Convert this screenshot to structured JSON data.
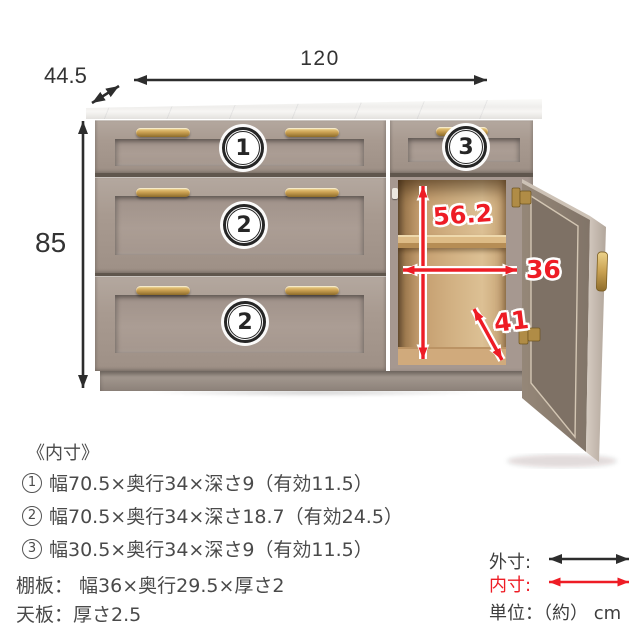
{
  "diagram": {
    "outer": {
      "width": "120",
      "depth": "44.5",
      "height": "85"
    },
    "inner": {
      "height": "56.2",
      "width": "36",
      "diagonal": "41"
    },
    "badges": [
      {
        "id": "drawer-1",
        "num": "1"
      },
      {
        "id": "drawer-2-middle",
        "num": "2"
      },
      {
        "id": "drawer-2-bottom",
        "num": "2"
      },
      {
        "id": "drawer-3",
        "num": "3"
      }
    ]
  },
  "specs": {
    "heading": "《内寸》",
    "items": [
      {
        "num": "1",
        "text": "幅70.5×奥行34×深さ9（有効11.5）"
      },
      {
        "num": "2",
        "text": "幅70.5×奥行34×深さ18.7（有効24.5）"
      },
      {
        "num": "3",
        "text": "幅30.5×奥行34×深さ9（有効11.5）"
      }
    ],
    "shelf": "棚板： 幅36×奥行29.5×厚さ2",
    "top": "天板：厚さ2.5"
  },
  "legend": {
    "outer_label": "外寸:",
    "inner_label": "内寸:",
    "unit_label": "単位：（約） cm"
  },
  "colors": {
    "accent_red": "#ee1c25",
    "arrow_black": "#2d2d2d",
    "cabinet_taupe": "#a89a90",
    "brass": "#c9a152",
    "marble": "#f2f1ef",
    "wood_interior": "#d2b183",
    "text": "#4a4a4a"
  }
}
